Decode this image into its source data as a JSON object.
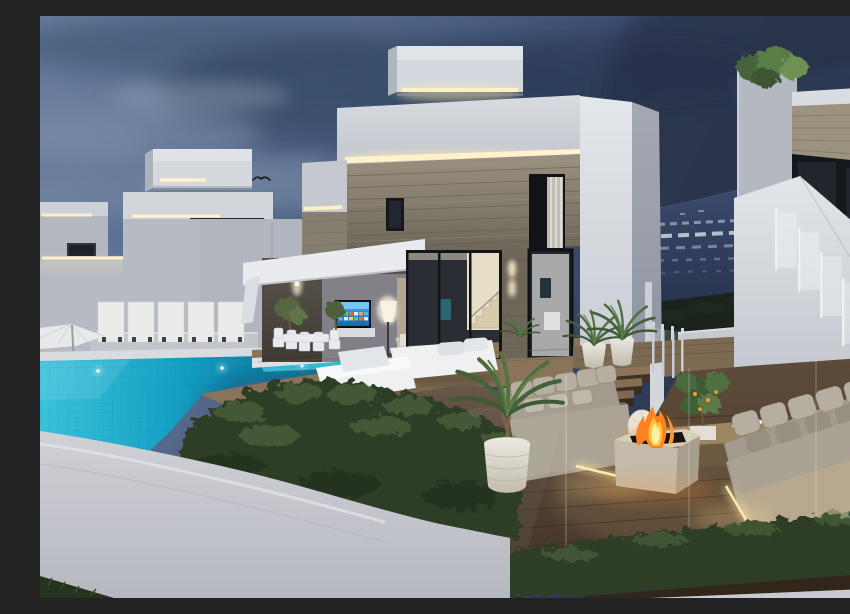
{
  "scene": {
    "type": "architectural-render",
    "description": "Dusk 3D render of modern white villas with infinity pool, wooden lounge deck, fire pit and hedges",
    "time_of_day": "dusk",
    "colors": {
      "sky1": "#6b7fa0",
      "sky2": "#566a8c",
      "sky3": "#3e5074",
      "sky4": "#2b374f",
      "sky5": "#252e45",
      "cloud_dark": "#33455f",
      "cloud_light": "#8ea0b6",
      "hill_top": "#3a4a6c",
      "hill_bottom": "#1f2940",
      "white_lit": "#e9ebee",
      "white_mid": "#c6c9d0",
      "white_shadow": "#a8acb5",
      "stone": "#948b7a",
      "stone_dark": "#6e675a",
      "led_core": "#fff2cc",
      "led_glow": "#ffeec0",
      "frame_dark": "#15181d",
      "tv_blue": "#2e8fd2",
      "pool_bright": "#3cc3dc",
      "pool_mid": "#15a0c4",
      "pool_deep": "#0b6b92",
      "hedge_dark": "#2e3d28",
      "hedge_mid": "#44563a",
      "hedge_light": "#5a7344",
      "deck_light": "#8a7459",
      "deck_mid": "#5e4c3a",
      "deck_dark": "#44362a",
      "sofa_light": "#b6afa1",
      "sofa_mid": "#a29b8d",
      "sofa_base": "#b7a88f",
      "fire_orange": "#ff821f",
      "fire_yellow": "#ffc43e",
      "firepit_light": "#c3baa9",
      "firepit_side": "#a79e8d",
      "wall_fg": "#d0d1d7",
      "wall_fg_dark": "#b6b8c0",
      "grass_dark": "#26331e",
      "soil": "#32261a",
      "plant_green": "#4d6c3c",
      "plant_light": "#618049",
      "interior_warm": "#e6dec6",
      "lamp_glow": "#f6efda",
      "glass_frost": "#e9ece8"
    },
    "objects": [
      {
        "name": "dusk-sky"
      },
      {
        "name": "bird"
      },
      {
        "name": "left-villa-a"
      },
      {
        "name": "left-villa-b"
      },
      {
        "name": "main-villa"
      },
      {
        "name": "rooftop-box"
      },
      {
        "name": "led-strips"
      },
      {
        "name": "stone-cladding"
      },
      {
        "name": "porch-canopy"
      },
      {
        "name": "outdoor-tv"
      },
      {
        "name": "dining-set"
      },
      {
        "name": "floor-lamp"
      },
      {
        "name": "staircase"
      },
      {
        "name": "right-villa"
      },
      {
        "name": "glass-balustrade"
      },
      {
        "name": "rooftop-shrub"
      },
      {
        "name": "distant-hillside"
      },
      {
        "name": "infinity-pool"
      },
      {
        "name": "underwater-lights"
      },
      {
        "name": "frosted-glass-fence"
      },
      {
        "name": "patio-umbrella"
      },
      {
        "name": "sun-loungers"
      },
      {
        "name": "wood-deck"
      },
      {
        "name": "deck-steps"
      },
      {
        "name": "potted-palms"
      },
      {
        "name": "lounge-sofa-left"
      },
      {
        "name": "lounge-sofa-right"
      },
      {
        "name": "fire-pit"
      },
      {
        "name": "coffee-table"
      },
      {
        "name": "citrus-tree"
      },
      {
        "name": "hedge-large"
      },
      {
        "name": "hedge-row"
      },
      {
        "name": "boundary-wall"
      },
      {
        "name": "grass-corner"
      }
    ]
  }
}
